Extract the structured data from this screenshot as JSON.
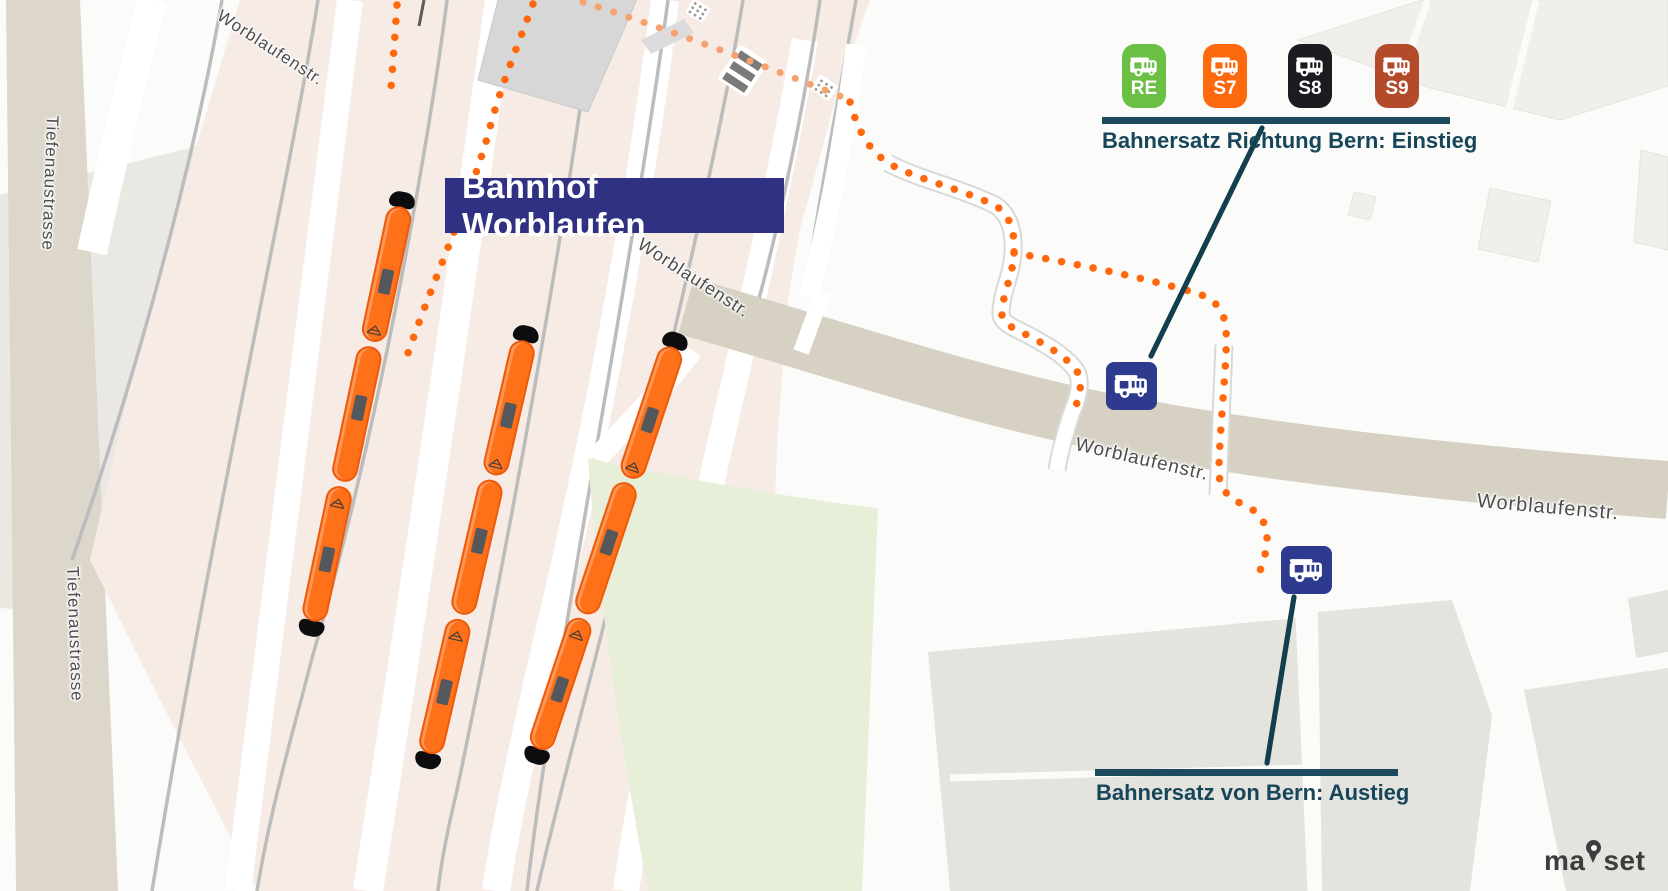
{
  "map": {
    "station_label": "Bahnhof Worblaufen",
    "streets": {
      "worblaufenstr": "Worblaufenstr.",
      "tiefenaustrasse": "Tiefenaustrasse"
    }
  },
  "bus_replacement": {
    "boarding": {
      "caption": "Bahnersatz Richtung Bern: Einstieg",
      "lines": [
        {
          "id": "RE",
          "color": "#6cbf45"
        },
        {
          "id": "S7",
          "color": "#fc6a0d"
        },
        {
          "id": "S8",
          "color": "#1b1c20"
        },
        {
          "id": "S9",
          "color": "#b34b2b"
        }
      ]
    },
    "alighting": {
      "caption": "Bahnersatz von Bern: Austieg"
    }
  },
  "branding": {
    "logo_prefix": "ma",
    "logo_suffix": "set",
    "logo_full": "mapset"
  },
  "colors": {
    "annotation_teal": "#17465a",
    "marker_navy": "#2d3a8e",
    "station_label_navy": "#313183",
    "route_dot_orange": "#ff680d",
    "train_orange": "#ff7119"
  }
}
